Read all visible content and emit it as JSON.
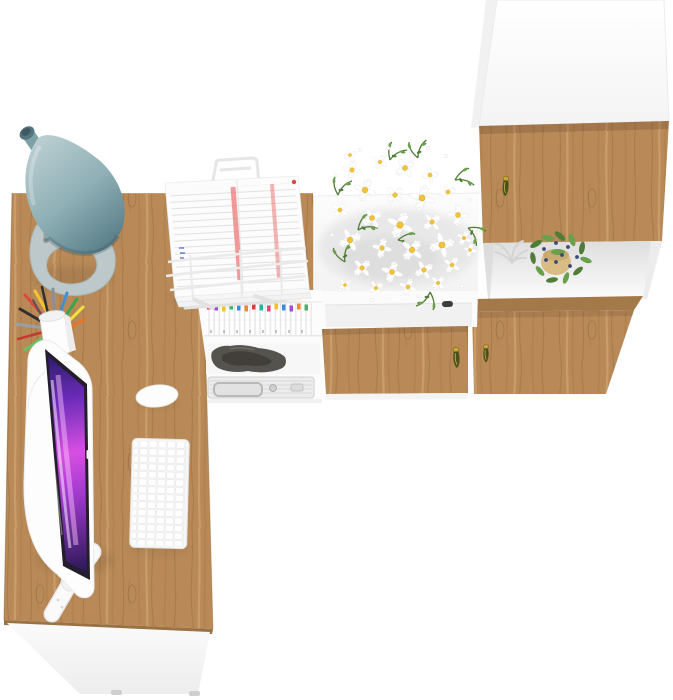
{
  "scene": {
    "title": "Top-down render of a home office furniture set",
    "background": "#ffffff"
  },
  "colors": {
    "wood_base": "#b98a58",
    "wood_streak_dark": "#8a6138",
    "wood_streak_mid": "#a0753f",
    "wood_streak_light": "#d8b079",
    "wood_edge": "#9a7244",
    "furniture_white": "#fdfdfd",
    "shadow_grey": "#e7e7e7",
    "lamp_light": "#b9cdd0",
    "lamp_mid": "#8fb0b6",
    "lamp_dark": "#587d88",
    "lamp_base": "#bcc8c9",
    "lamp_rod": "#95a3a4",
    "handle_gold": "#c9a63c",
    "handle_body": "#4a4f1e",
    "screen_navy": "#241a5e",
    "screen_violet": "#6a2bb8",
    "screen_magenta": "#d84fe2",
    "screen_purple": "#a23ad0",
    "screen_deep": "#191343",
    "daisy_petal": "#ffffff",
    "daisy_center": "#f1c437",
    "leaf_green": "#4f7c36",
    "leaf_green_light": "#6aa04b",
    "berry_blue": "#3a4a75",
    "pot_beige": "#d9bd85",
    "coral_grey": "#d4d4d4",
    "knob_dark": "#3c3c3c",
    "case_silver": "#ececec",
    "paper_white": "#fcfcfc",
    "paper_stripe_red": "#ee7a7a",
    "paper_dot_red": "#e04343",
    "pencil_palette": [
      "#2f2f2f",
      "#8a8f94",
      "#e0483e",
      "#f2c52c",
      "#3aa74a",
      "#3f8fd4",
      "#e2762f",
      "#c23a30",
      "#98a0a6",
      "#62c462",
      "#f2e23a",
      "#555555"
    ],
    "tab_palette": [
      "#e8467c",
      "#a04fc9",
      "#f3c623",
      "#45b36b",
      "#3a8fd9",
      "#f08c2e",
      "#d94040",
      "#28b5a3"
    ]
  },
  "objects": {
    "desk": {
      "label": "L-shaped desk with oak top and white front panel"
    },
    "lamp": {
      "label": "Teal cone desk lamp"
    },
    "monitor": {
      "label": "White monitor with purple abstract wallpaper"
    },
    "keyboard": {
      "label": "White compact wireless keyboard"
    },
    "mouse": {
      "label": "White wireless mouse"
    },
    "pencil_cup": {
      "label": "White cup with colored pens and pencils"
    },
    "document_stand": {
      "label": "White wire document stand holding papers"
    },
    "hutch": {
      "label": "Under-desk shelves with binders, dark bag and metal case"
    },
    "sideboard": {
      "label": "White sideboard with oak drawer front"
    },
    "flowers": {
      "label": "Bouquet of white daisies"
    },
    "tall_cabinet": {
      "label": "Tall white wardrobe with oak doors and open shelf"
    },
    "plant": {
      "label": "Potted plant with blue berries"
    },
    "coral": {
      "label": "White decorative coral"
    }
  }
}
